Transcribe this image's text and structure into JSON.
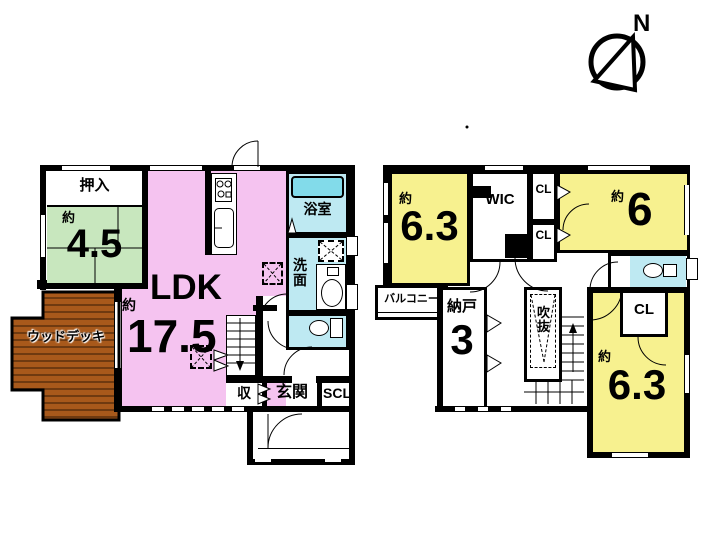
{
  "compass": {
    "north_label": "N"
  },
  "colors": {
    "pink": "#F5C3F0",
    "green": "#C8E7BE",
    "yellow": "#F7F18F",
    "cyan": "#BEE9F2",
    "tub": "#82DBEA",
    "deck": "#A8591B",
    "deck_stripe": "#6F3A10",
    "wall": "#000000"
  },
  "floor1": {
    "oshiire": "押入",
    "tatami": {
      "approx": "約",
      "size": "4.5"
    },
    "ldk": {
      "name": "LDK",
      "approx": "約",
      "size": "17.5"
    },
    "bath": "浴室",
    "washroom": "洗面",
    "storage": "収",
    "entrance": "玄関",
    "shoe_closet": "SCL",
    "wood_deck": "ウッドデッキ"
  },
  "floor2": {
    "bedroom_a": {
      "approx": "約",
      "size": "6.3"
    },
    "wic": "WIC",
    "closet_top": "CL",
    "closet_mid": "CL",
    "bedroom_b": {
      "approx": "約",
      "size": "6"
    },
    "balcony": "バルコニー",
    "storage_room": {
      "name": "納戸",
      "size": "3"
    },
    "atrium": "吹抜",
    "closet_bottom": "CL",
    "bedroom_c": {
      "approx": "約",
      "size": "6.3"
    }
  }
}
